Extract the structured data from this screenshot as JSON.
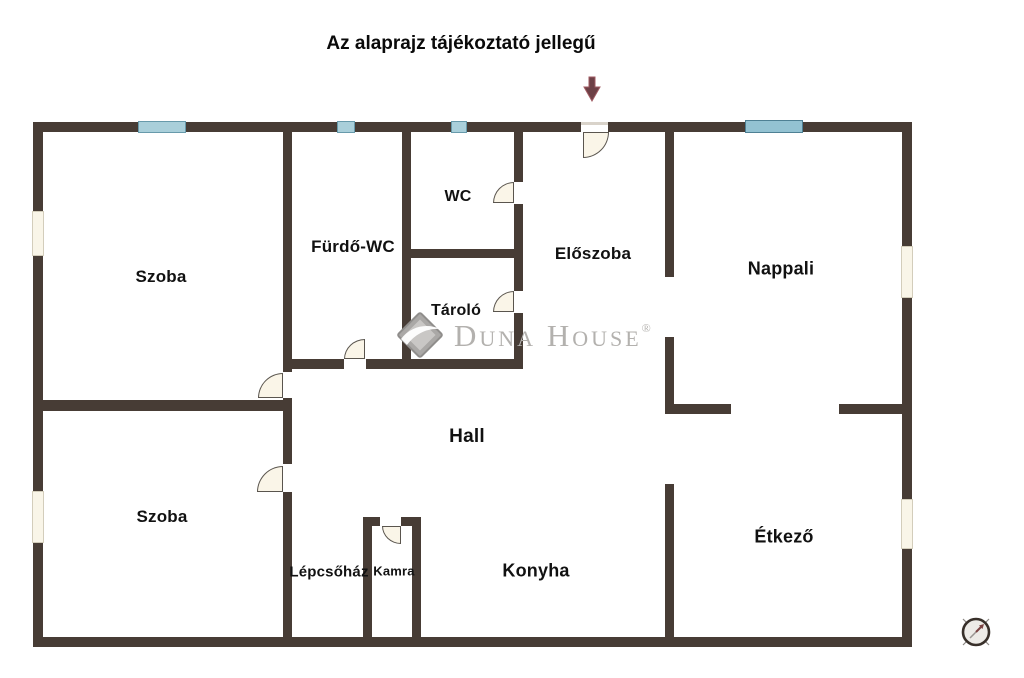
{
  "title": "Az alaprajz tájékoztató jellegű",
  "rooms": {
    "szoba1": {
      "label": "Szoba"
    },
    "furdo_wc": {
      "label": "Fürdő-WC"
    },
    "wc": {
      "label": "WC"
    },
    "tarolo": {
      "label": "Tároló"
    },
    "eloszoba": {
      "label": "Előszoba"
    },
    "nappali": {
      "label": "Nappali"
    },
    "hall": {
      "label": "Hall"
    },
    "szoba2": {
      "label": "Szoba"
    },
    "lepcsohaz": {
      "label": "Lépcsőház"
    },
    "kamra": {
      "label": "Kamra"
    },
    "konyha": {
      "label": "Konyha"
    },
    "etkezo": {
      "label": "Étkező"
    }
  },
  "watermark": {
    "duna": "Duna",
    "house": "House",
    "reg": "®"
  },
  "icons": {
    "entrance_arrow": "downward entrance arrow",
    "compass": "north compass rose",
    "logo_diamond": "Duna House diamond logo"
  },
  "colors": {
    "wall": "#473c35",
    "window_blue": "#a9cfda",
    "window_blue_large": "#93c2d2",
    "window_cream": "#f9f5e8",
    "door_fill": "#faf5e8",
    "door_stroke": "#5a554e",
    "arrow": "#6d4046",
    "watermark_gray": "#b3b1ae",
    "compass_ring": "#38302a",
    "compass_needle": "#7b4343"
  }
}
